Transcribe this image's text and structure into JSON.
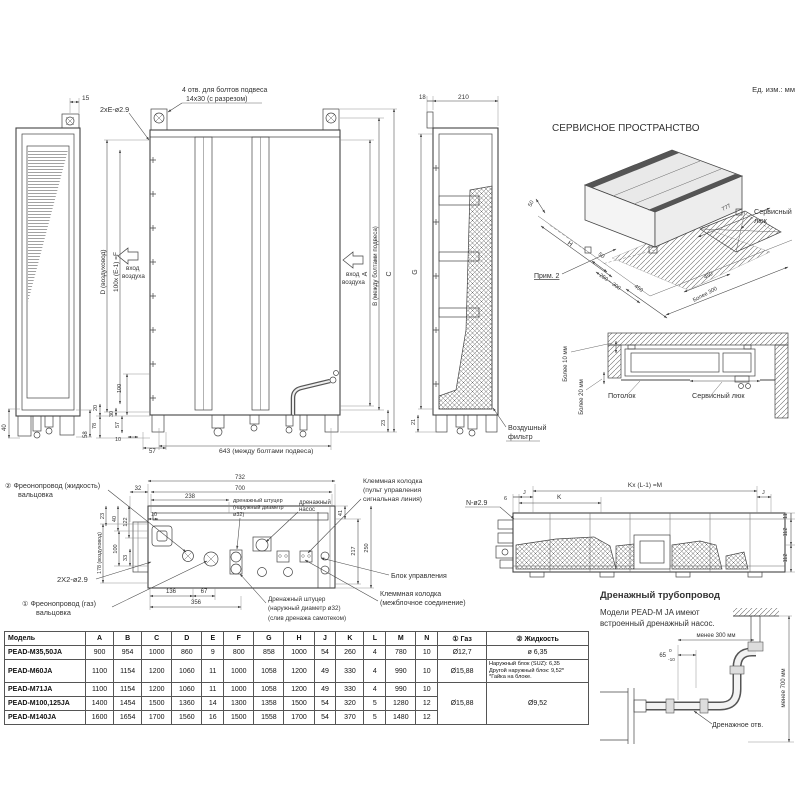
{
  "table": {
    "headers": [
      "Модель",
      "A",
      "B",
      "C",
      "D",
      "E",
      "F",
      "G",
      "H",
      "J",
      "K",
      "L",
      "M",
      "N",
      "① Газ",
      "② Жидкость"
    ],
    "rows": [
      {
        "cells": [
          "PEAD-M35,50JA",
          "900",
          "954",
          "1000",
          "860",
          "9",
          "800",
          "858",
          "1000",
          "54",
          "260",
          "4",
          "780",
          "10",
          "Ø12,7",
          "ø 6,35"
        ]
      },
      {
        "cells": [
          "PEAD-M60JA",
          "1100",
          "1154",
          "1200",
          "1060",
          "11",
          "1000",
          "1058",
          "1200",
          "49",
          "330",
          "4",
          "990",
          "10",
          "Ø15,88",
          {
            "t": "Наружный блок (SUZ): 6,35\nДругой наружный блок: 9,52*\n*Гайка на блоке.",
            "cls": "small"
          }
        ]
      },
      {
        "cells": [
          "PEAD-M71JA",
          "1100",
          "1154",
          "1200",
          "1060",
          "11",
          "1000",
          "1058",
          "1200",
          "49",
          "330",
          "4",
          "990",
          "10",
          {
            "t": "Ø15,88",
            "rs": 3
          },
          {
            "t": "Ø9,52",
            "rs": 3
          }
        ]
      },
      {
        "cells": [
          "PEAD-M100,125JA",
          "1400",
          "1454",
          "1500",
          "1360",
          "14",
          "1300",
          "1358",
          "1500",
          "54",
          "320",
          "5",
          "1280",
          "12"
        ]
      },
      {
        "cells": [
          "PEAD-M140JA",
          "1600",
          "1654",
          "1700",
          "1560",
          "16",
          "1500",
          "1558",
          "1700",
          "54",
          "370",
          "5",
          "1480",
          "12"
        ]
      }
    ]
  },
  "labels": [
    {
      "n": "units-label",
      "t": "Ед. изм.: мм",
      "x": 795,
      "y": 92,
      "a": "end",
      "s": 7.5
    },
    {
      "n": "dim-15",
      "t": "15",
      "x": 82,
      "y": 100,
      "s": 6.5
    },
    {
      "n": "dim-40",
      "t": "40",
      "x": 6,
      "y": 431,
      "r": -90,
      "s": 6
    },
    {
      "n": "dim-58",
      "t": "58",
      "x": 87,
      "y": 438,
      "r": -90,
      "s": 6
    },
    {
      "n": "note-suspension-holes-1",
      "t": "4 отв. для болтов подвеса",
      "x": 182,
      "y": 92,
      "s": 7
    },
    {
      "n": "note-suspension-holes-2",
      "t": "14x30 (с разрезом)",
      "x": 186,
      "y": 101,
      "s": 7
    },
    {
      "n": "note-2xE",
      "t": "2xE-ø2.9",
      "x": 100,
      "y": 112,
      "s": 7.2
    },
    {
      "n": "dim-D-duct",
      "t": "D (воздуховод)",
      "x": 105,
      "y": 272,
      "r": -90,
      "a": "middle",
      "s": 6.5
    },
    {
      "n": "dim-F",
      "t": "100x (E-1) =F",
      "x": 118,
      "y": 272,
      "r": -90,
      "a": "middle",
      "s": 6.5
    },
    {
      "n": "air-inlet-left-1",
      "t": "вход",
      "x": 126,
      "y": 270,
      "s": 6.3
    },
    {
      "n": "air-inlet-left-2",
      "t": "воздуха",
      "x": 122,
      "y": 278,
      "s": 6.3
    },
    {
      "n": "air-inlet-right-1",
      "t": "вход",
      "x": 346,
      "y": 276,
      "s": 6.3
    },
    {
      "n": "air-inlet-right-2",
      "t": "воздуха",
      "x": 342,
      "y": 284,
      "s": 6.3
    },
    {
      "n": "dim-A",
      "t": "A",
      "x": 367,
      "y": 274,
      "r": -90,
      "a": "middle",
      "s": 7
    },
    {
      "n": "dim-B",
      "t": "B (между болтами подвеса)",
      "x": 377,
      "y": 266,
      "r": -90,
      "a": "middle",
      "s": 6.2
    },
    {
      "n": "dim-C",
      "t": "C",
      "x": 391,
      "y": 274,
      "r": -90,
      "a": "middle",
      "s": 7
    },
    {
      "n": "dim-23",
      "t": "23",
      "x": 385,
      "y": 426,
      "r": -90,
      "s": 5.5
    },
    {
      "n": "dim-100",
      "t": "100",
      "x": 121,
      "y": 393,
      "r": -90,
      "s": 5.5
    },
    {
      "n": "dim-20",
      "t": "20",
      "x": 97,
      "y": 411,
      "r": -90,
      "s": 5.5
    },
    {
      "n": "dim-78",
      "t": "78",
      "x": 96,
      "y": 429,
      "r": -90,
      "s": 5.5
    },
    {
      "n": "dim-30",
      "t": "30",
      "x": 113,
      "y": 417,
      "r": -90,
      "s": 5.5
    },
    {
      "n": "dim-57v",
      "t": "57",
      "x": 119,
      "y": 428,
      "r": -90,
      "s": 5.5
    },
    {
      "n": "dim-10",
      "t": "10",
      "x": 115,
      "y": 441,
      "s": 5.5
    },
    {
      "n": "dim-57h",
      "t": "57",
      "x": 149,
      "y": 453,
      "s": 6
    },
    {
      "n": "dim-643",
      "t": "643 (между болтами подвеса)",
      "x": 219,
      "y": 453,
      "s": 6.8
    },
    {
      "n": "dim-18",
      "t": "18",
      "x": 419,
      "y": 99,
      "s": 6
    },
    {
      "n": "dim-210",
      "t": "210",
      "x": 458,
      "y": 99,
      "s": 6.5
    },
    {
      "n": "dim-G",
      "t": "G",
      "x": 417,
      "y": 272,
      "r": -90,
      "a": "middle",
      "s": 7
    },
    {
      "n": "dim-21",
      "t": "21",
      "x": 415,
      "y": 425,
      "r": -90,
      "s": 5.5
    },
    {
      "n": "air-filter-label-1",
      "t": "Воздушный",
      "x": 508,
      "y": 430,
      "s": 7.2
    },
    {
      "n": "air-filter-label-2",
      "t": "фильтр",
      "x": 508,
      "y": 439,
      "s": 7.2
    },
    {
      "n": "service-space-title",
      "t": "СЕРВИСНОЕ ПРОСТРАНСТВО",
      "x": 552,
      "y": 131,
      "s": 10
    },
    {
      "n": "iso-dim-50-left",
      "t": "50",
      "x": 531,
      "y": 207,
      "r": -62,
      "s": 5.5
    },
    {
      "n": "iso-dim-H",
      "t": "H",
      "x": 567,
      "y": 244,
      "r": 35,
      "s": 6.5
    },
    {
      "n": "iso-note-2",
      "t": "Прим. 2",
      "x": 534,
      "y": 278,
      "s": 7,
      "u": true
    },
    {
      "n": "iso-dim-50-mid",
      "t": "50",
      "x": 598,
      "y": 255,
      "r": 35,
      "s": 5.5
    },
    {
      "n": "iso-dim-250-300",
      "t": "250 ~ 300",
      "x": 599,
      "y": 276,
      "r": 35,
      "s": 5.5
    },
    {
      "n": "iso-dim-450-left",
      "t": "450",
      "x": 634,
      "y": 287,
      "r": 35,
      "s": 5.5
    },
    {
      "n": "iso-dim-777",
      "t": "777",
      "x": 723,
      "y": 211,
      "r": -28,
      "s": 5.5
    },
    {
      "n": "iso-dim-450-right",
      "t": "450",
      "x": 705,
      "y": 279,
      "r": -28,
      "s": 5.5
    },
    {
      "n": "iso-dim-more-300",
      "t": "Более 300",
      "x": 694,
      "y": 302,
      "r": -28,
      "s": 5.5
    },
    {
      "n": "service-hatch-label-1",
      "t": "Сервисный",
      "x": 754,
      "y": 214,
      "s": 7.2
    },
    {
      "n": "service-hatch-label-2",
      "t": "люк",
      "x": 754,
      "y": 223,
      "s": 7.2
    },
    {
      "n": "dim-more-10mm",
      "t": "Более 10 мм",
      "x": 567,
      "y": 364,
      "r": -90,
      "a": "middle",
      "s": 6
    },
    {
      "n": "dim-more-20mm",
      "t": "Более 20 мм",
      "x": 583,
      "y": 397,
      "r": -90,
      "a": "middle",
      "s": 6
    },
    {
      "n": "ceiling-label",
      "t": "Потолок",
      "x": 608,
      "y": 398,
      "s": 7.2
    },
    {
      "n": "service-hatch-section-label",
      "t": "Сервисный люк",
      "x": 692,
      "y": 398,
      "s": 7.2
    },
    {
      "n": "dim-732",
      "t": "732",
      "x": 240,
      "y": 479,
      "a": "middle",
      "s": 6
    },
    {
      "n": "dim-700",
      "t": "700",
      "x": 240,
      "y": 490,
      "a": "middle",
      "s": 6
    },
    {
      "n": "dim-238",
      "t": "238",
      "x": 190,
      "y": 498,
      "a": "middle",
      "s": 6
    },
    {
      "n": "dim-32",
      "t": "32",
      "x": 138,
      "y": 490,
      "a": "middle",
      "s": 6
    },
    {
      "n": "dim-10b",
      "t": "10",
      "x": 151,
      "y": 516,
      "s": 5.5
    },
    {
      "n": "dim-23b",
      "t": "23",
      "x": 104,
      "y": 516,
      "r": -90,
      "a": "middle",
      "s": 5.5
    },
    {
      "n": "dim-40b",
      "t": "40",
      "x": 116,
      "y": 519,
      "r": -90,
      "a": "middle",
      "s": 5.5
    },
    {
      "n": "dim-122",
      "t": "122",
      "x": 127,
      "y": 522,
      "r": -90,
      "a": "middle",
      "s": 5.5
    },
    {
      "n": "dim-178",
      "t": "178 (воздуховод)",
      "x": 101,
      "y": 553,
      "r": -90,
      "a": "middle",
      "s": 5.3
    },
    {
      "n": "dim-100b",
      "t": "100",
      "x": 117,
      "y": 549,
      "r": -90,
      "a": "middle",
      "s": 5.5
    },
    {
      "n": "dim-33",
      "t": "33",
      "x": 127,
      "y": 558,
      "r": -90,
      "a": "middle",
      "s": 5.5
    },
    {
      "n": "dim-136",
      "t": "136",
      "x": 171,
      "y": 593,
      "a": "middle",
      "s": 6
    },
    {
      "n": "dim-67",
      "t": "67",
      "x": 204,
      "y": 593,
      "a": "middle",
      "s": 6
    },
    {
      "n": "dim-356",
      "t": "356",
      "x": 196,
      "y": 604,
      "a": "middle",
      "s": 6
    },
    {
      "n": "dim-41",
      "t": "41",
      "x": 342,
      "y": 513,
      "r": -90,
      "a": "middle",
      "s": 5.5
    },
    {
      "n": "dim-217",
      "t": "217",
      "x": 355,
      "y": 551,
      "r": -90,
      "a": "middle",
      "s": 5.5
    },
    {
      "n": "dim-250",
      "t": "250",
      "x": 368,
      "y": 548,
      "r": -90,
      "a": "middle",
      "s": 5.5
    },
    {
      "n": "callout-liquid-pipe-1",
      "t": "② Фреонопровод (жидкость)",
      "x": 5,
      "y": 488,
      "s": 7.2
    },
    {
      "n": "callout-liquid-pipe-2",
      "t": "вальцовка",
      "x": 18,
      "y": 497,
      "s": 7.2
    },
    {
      "n": "callout-2x2",
      "t": "2X2-ø2.9",
      "x": 57,
      "y": 582,
      "s": 7.5
    },
    {
      "n": "callout-gas-pipe-1",
      "t": "① Фреонопровод (газ)",
      "x": 22,
      "y": 606,
      "s": 7.2
    },
    {
      "n": "callout-gas-pipe-2",
      "t": "вальцовка",
      "x": 36,
      "y": 615,
      "s": 7.2
    },
    {
      "n": "label-drain-nozzle-top-1",
      "t": "дренажный штуцер",
      "x": 233,
      "y": 502,
      "s": 5.5
    },
    {
      "n": "label-drain-nozzle-top-2",
      "t": "(наружный диаметр",
      "x": 233,
      "y": 509,
      "s": 5.5
    },
    {
      "n": "label-drain-nozzle-top-3",
      "t": "ø32)",
      "x": 233,
      "y": 516,
      "s": 5.5
    },
    {
      "n": "label-drain-pump-1",
      "t": "дренажный",
      "x": 299,
      "y": 504,
      "s": 6
    },
    {
      "n": "label-drain-pump-2",
      "t": "насос",
      "x": 299,
      "y": 511,
      "s": 6
    },
    {
      "n": "label-terminal-remote-1",
      "t": "Клеммная колодка",
      "x": 363,
      "y": 483,
      "s": 6.8
    },
    {
      "n": "label-terminal-remote-2",
      "t": "(пульт управления",
      "x": 363,
      "y": 492,
      "s": 6.8
    },
    {
      "n": "label-terminal-remote-3",
      "t": "сигнальная линия)",
      "x": 363,
      "y": 501,
      "s": 6.8
    },
    {
      "n": "label-control-box",
      "t": "Блок управления",
      "x": 391,
      "y": 578,
      "s": 7
    },
    {
      "n": "label-terminal-interunit-1",
      "t": "Клеммная колодка",
      "x": 380,
      "y": 596,
      "s": 7
    },
    {
      "n": "label-terminal-interunit-2",
      "t": "(межблочное соединение)",
      "x": 380,
      "y": 605,
      "s": 7
    },
    {
      "n": "label-drain-nozzle-bottom-1",
      "t": "Дренажный штуцер",
      "x": 268,
      "y": 601,
      "s": 6.3
    },
    {
      "n": "label-drain-nozzle-bottom-2",
      "t": "(наружный диаметр ø32)",
      "x": 268,
      "y": 610,
      "s": 6.3
    },
    {
      "n": "label-drain-nozzle-bottom-3",
      "t": "(слив дренажа самотеком)",
      "x": 268,
      "y": 620,
      "s": 6.3
    },
    {
      "n": "note-N-holes",
      "t": "N-ø2.9",
      "x": 466,
      "y": 505,
      "s": 7
    },
    {
      "n": "dim-6",
      "t": "6",
      "x": 504,
      "y": 500,
      "s": 5.5
    },
    {
      "n": "dim-J-left",
      "t": "J",
      "x": 523,
      "y": 494,
      "s": 5.5
    },
    {
      "n": "dim-K",
      "t": "K",
      "x": 557,
      "y": 499,
      "s": 6.5
    },
    {
      "n": "dim-KxM",
      "t": "Kx (L-1) =M",
      "x": 645,
      "y": 487,
      "a": "middle",
      "s": 6.5
    },
    {
      "n": "dim-J-right",
      "t": "J",
      "x": 762,
      "y": 494,
      "s": 5.5
    },
    {
      "n": "dim-11",
      "t": "11",
      "x": 787,
      "y": 516,
      "r": -90,
      "a": "middle",
      "s": 5.5
    },
    {
      "n": "dim-112a",
      "t": "112",
      "x": 787,
      "y": 532,
      "r": -90,
      "a": "middle",
      "s": 5.5
    },
    {
      "n": "dim-112b",
      "t": "112",
      "x": 787,
      "y": 558,
      "r": -90,
      "a": "middle",
      "s": 5.5
    },
    {
      "n": "drain-piping-title",
      "t": "Дренажный трубопровод",
      "x": 600,
      "y": 598,
      "s": 9.5,
      "w": true
    },
    {
      "n": "drain-piping-body-1",
      "t": "Модели PEAD-M JA имеют",
      "x": 600,
      "y": 615,
      "s": 8
    },
    {
      "n": "drain-piping-body-2",
      "t": "встроенный дренажный насос.",
      "x": 600,
      "y": 626,
      "s": 8
    },
    {
      "n": "dim-less-300",
      "t": "менее 300 мм",
      "x": 716,
      "y": 637,
      "a": "middle",
      "s": 6
    },
    {
      "n": "dim-65",
      "t": "65",
      "x": 666,
      "y": 657,
      "a": "end",
      "s": 6
    },
    {
      "n": "dim-65-tol-upper",
      "t": "0",
      "x": 669,
      "y": 652,
      "s": 4.8
    },
    {
      "n": "dim-65-tol-lower",
      "t": "-10",
      "x": 668,
      "y": 661,
      "s": 4.8
    },
    {
      "n": "label-drain-hole",
      "t": "Дренажное отв.",
      "x": 712,
      "y": 727,
      "s": 7
    },
    {
      "n": "dim-less-700",
      "t": "менее 700 мм",
      "x": 785,
      "y": 688,
      "r": -90,
      "a": "middle",
      "s": 6
    }
  ]
}
